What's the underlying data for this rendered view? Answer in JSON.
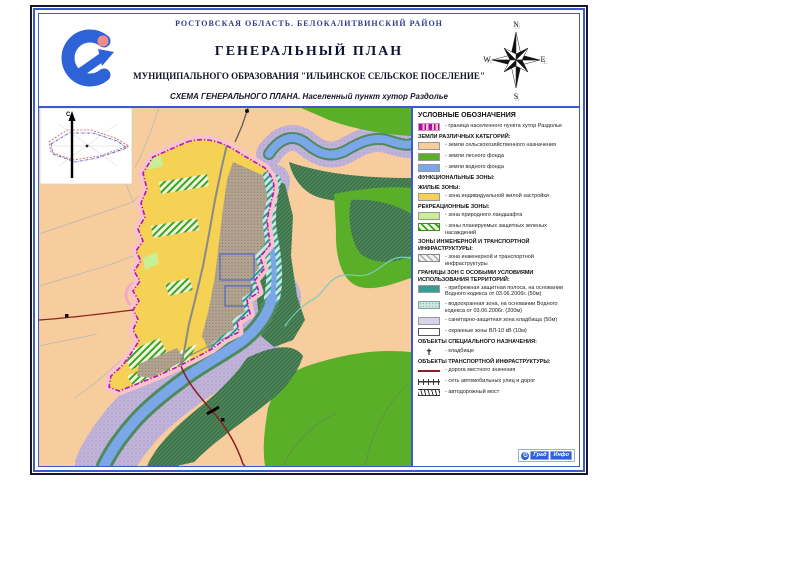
{
  "page": {
    "region_title": "РОСТОВСКАЯ ОБЛАСТЬ. БЕЛОКАЛИТВИНСКИЙ РАЙОН",
    "title": "ГЕНЕРАЛЬНЫЙ ПЛАН",
    "subtitle": "МУНИЦИПАЛЬНОГО ОБРАЗОВАНИЯ \"ИЛЬИНСКОЕ СЕЛЬСКОЕ ПОСЕЛЕНИЕ\"",
    "scheme_line": "СХЕМА ГЕНЕРАЛЬНОГО ПЛАНА. Населенный пункт хутор Раздолье"
  },
  "compass": {
    "n": "N",
    "e": "E",
    "s": "S",
    "w": "W"
  },
  "inset": {
    "north_label": "С"
  },
  "icons": {
    "cemetery_cross": "✝"
  },
  "footer": {
    "badge1": "Град",
    "badge2": "Инфо"
  },
  "colors": {
    "frame_blue": "#3b5bc7",
    "agricultural_tan": "#f7cd9e",
    "forest_green": "#5aaf28",
    "water_blue": "#7ba7e8",
    "residential_yellow": "#f5d154",
    "landscape_lightgreen": "#c8ee96",
    "coastal_teal": "#379e94",
    "water_zone_pale": "#cfe6df",
    "cemetery_zone_lavender": "#d8d2ea",
    "boundary_pink": "#f9c3cc",
    "boundary_magenta": "#b814b8",
    "road_red": "#8c1f1f"
  },
  "legend": {
    "rows": [
      {
        "text": "УСЛОВНЫЕ ОБОЗНАЧЕНИЯ"
      },
      {
        "label": "- граница населенного пункта хутор Раздолье"
      },
      {
        "text": "ЗЕМЛИ РАЗЛИЧНЫХ КАТЕГОРИЙ:"
      },
      {
        "label": "- земли сельскохозяйственного назначения"
      },
      {
        "label": "- земли лесного фонда"
      },
      {
        "label": "- земли водного фонда"
      },
      {
        "text": "ФУНКЦИОНАЛЬНЫЕ ЗОНЫ:"
      },
      {
        "text": "ЖИЛЫЕ ЗОНЫ:"
      },
      {
        "label": "- зона индивидуальной жилой застройки"
      },
      {
        "text": "РЕКРЕАЦИОННЫЕ ЗОНЫ:"
      },
      {
        "label": "- зона природного ландшафта"
      },
      {
        "label": "- зоны планируемых защитных зеленых насаждений"
      },
      {
        "text": "ЗОНЫ ИНЖЕНЕРНОЙ И ТРАНСПОРТНОЙ ИНФРАСТРУКТУРЫ:"
      },
      {
        "label": "- зона инженерной и транспортной инфраструктуры"
      },
      {
        "text": "ГРАНИЦЫ ЗОН С ОСОБЫМИ УСЛОВИЯМИ ИСПОЛЬЗОВАНИЯ ТЕРРИТОРИЙ:"
      },
      {
        "label": "- прибрежная защитная полоса, на основании Водного кодекса от 03.06.2006г. (50м)"
      },
      {
        "label": "- водоохранная зона, на основании Водного кодекса от 03.06.2006г. (200м)"
      },
      {
        "label": "- санитарно-защитная зона кладбища (50м)"
      },
      {
        "label": "- охранные зоны ВЛ-10 кВ (10м)"
      },
      {
        "text": "ОБЪЕКТЫ СПЕЦИАЛЬНОГО НАЗНАЧЕНИЯ:"
      },
      {
        "label": "- кладбище"
      },
      {
        "text": "ОБЪЕКТЫ ТРАНСПОРТНОЙ ИНФРАСТРУКТУРЫ:"
      },
      {
        "label": "- дорога местного значения"
      },
      {
        "label": "- сеть автомобильных улиц и дорог"
      },
      {
        "label": "- автодорожный мост"
      }
    ]
  }
}
